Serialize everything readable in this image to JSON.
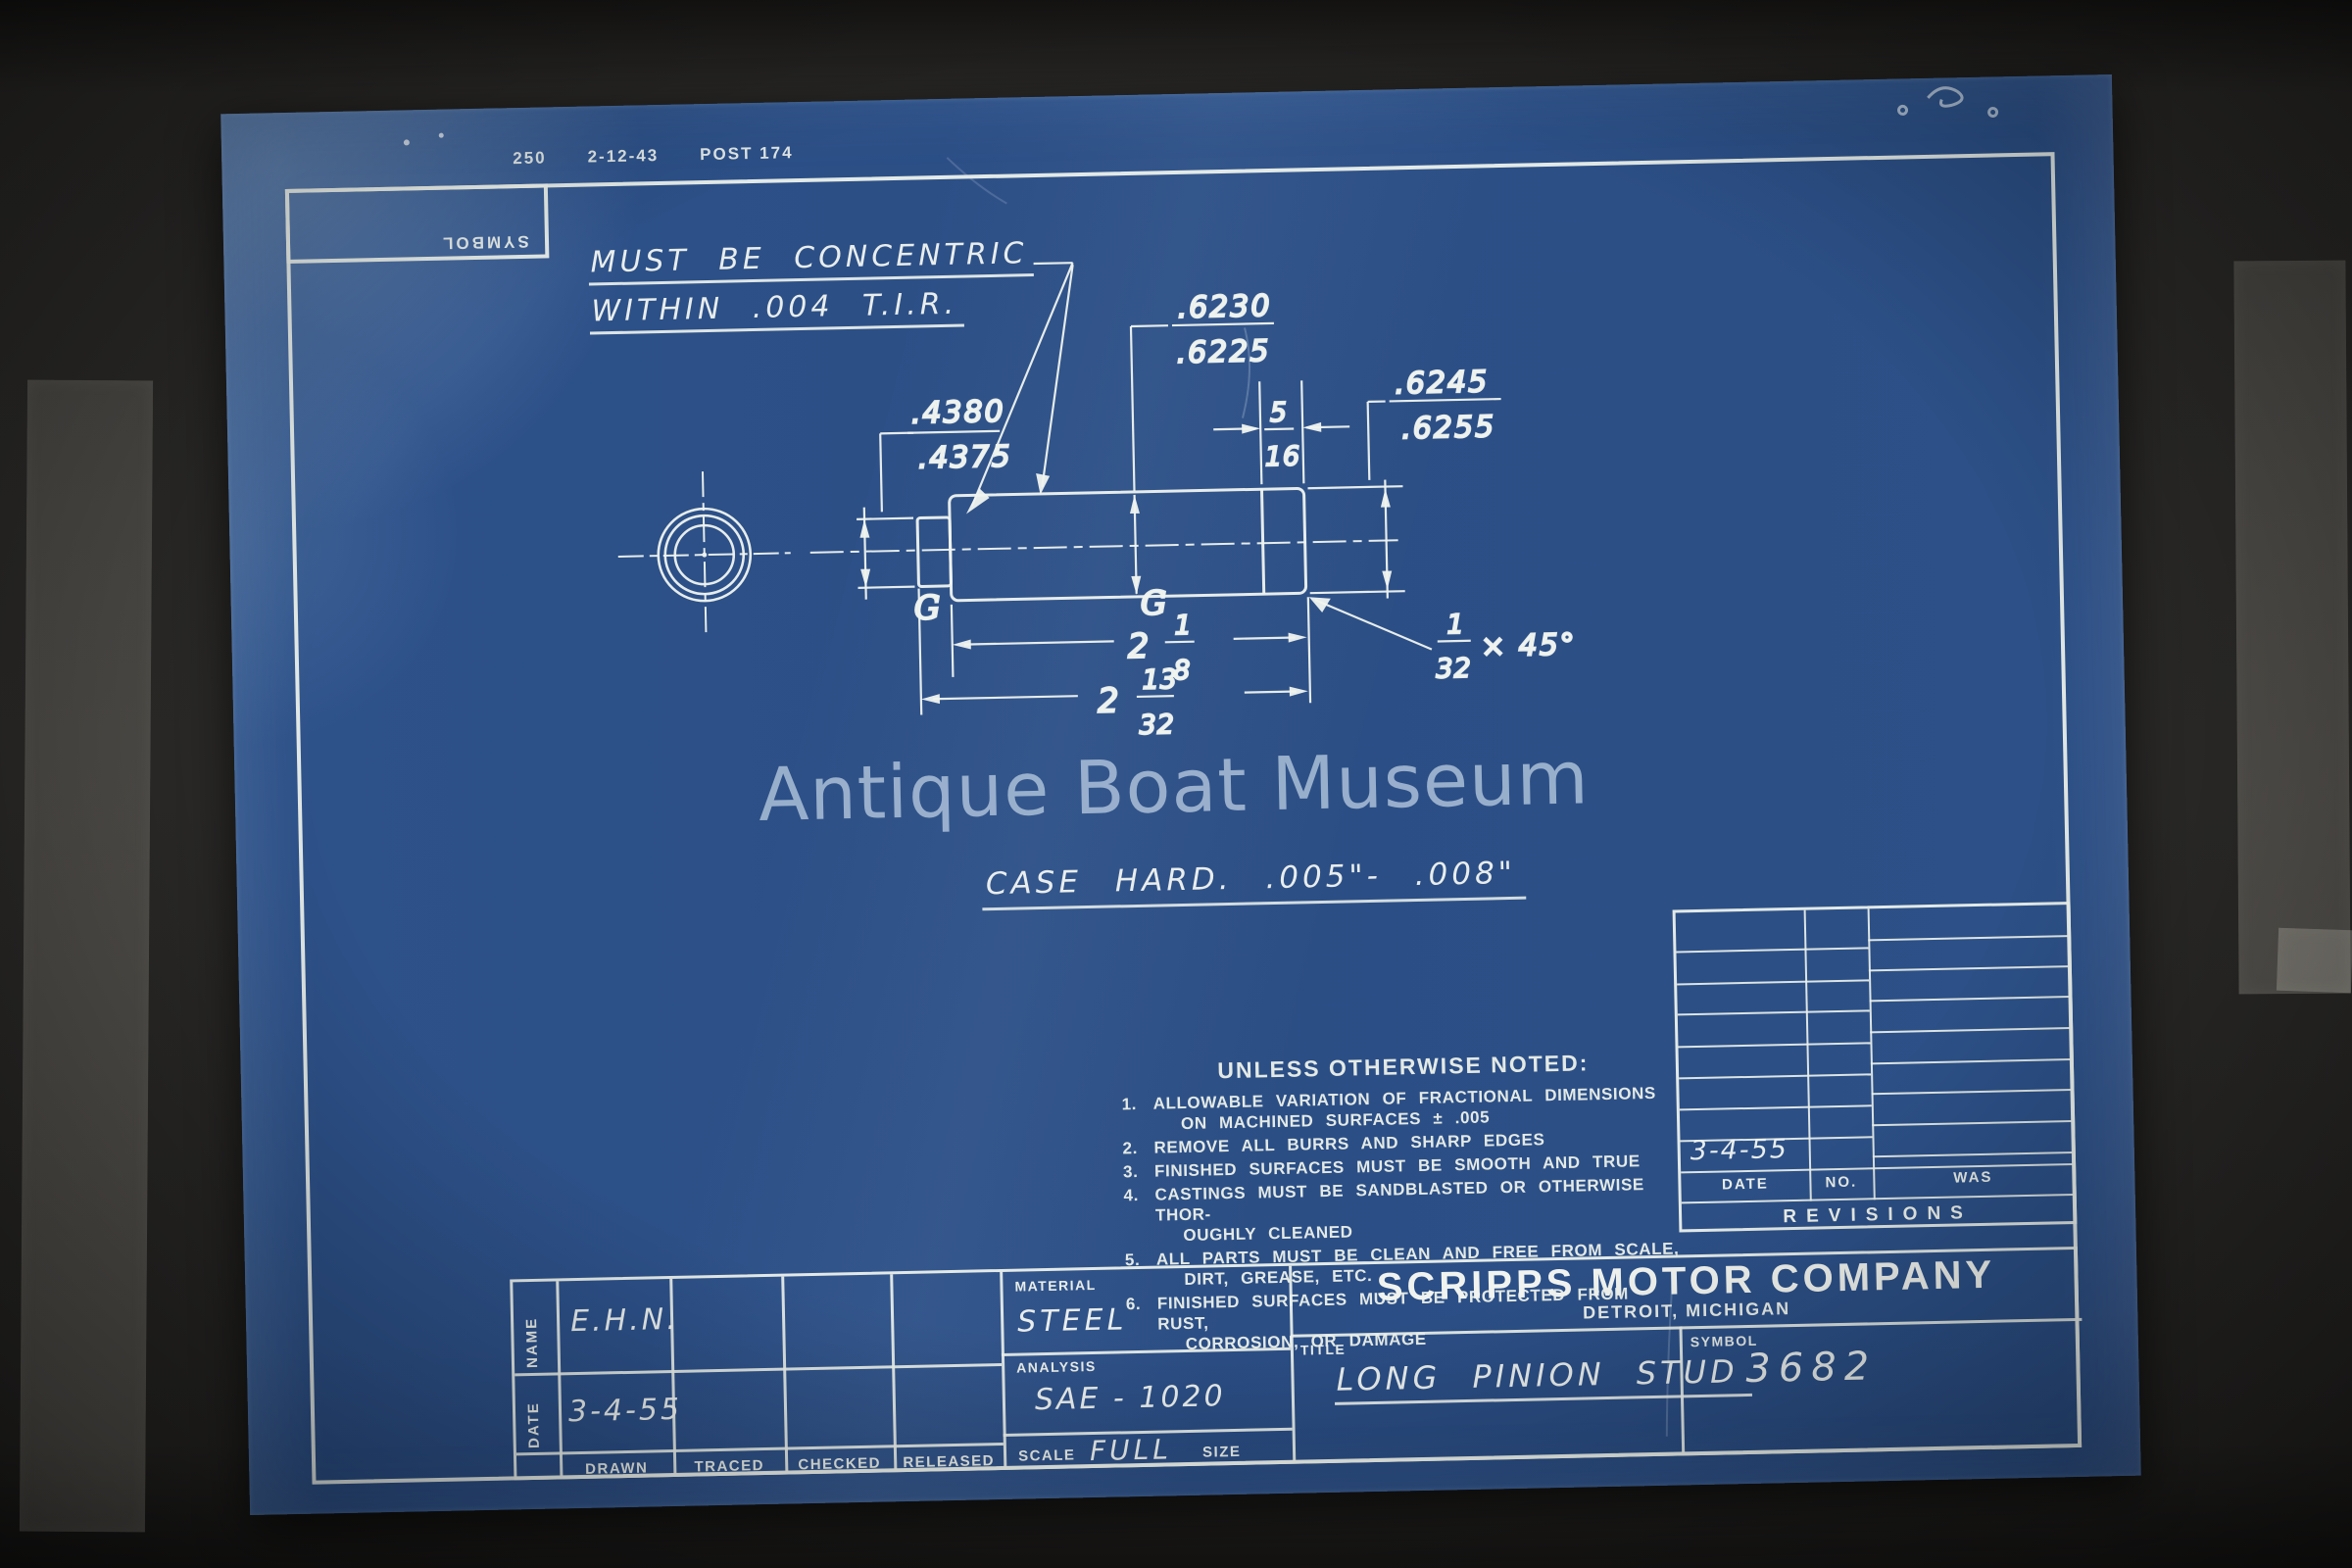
{
  "colors": {
    "blueprint": "#2b4e85",
    "ink": "#edf1ec",
    "watermark": "#acc0d8",
    "photo_background": "#2c2b29",
    "tape": "#cec8bc"
  },
  "stamp": {
    "part1": "250",
    "part2": "2-12-43",
    "part3": "POST 174"
  },
  "symbol_box": {
    "label": "SYMBOL"
  },
  "drawing": {
    "note_concentric_1": "MUST BE CONCENTRIC",
    "note_concentric_2": "WITHIN .004 T.I.R.",
    "case_hard_note": "CASE HARD.   .005\"- .008\"",
    "grind_mark": "G",
    "dims": {
      "stub_dia_upper": ".4380",
      "stub_dia_lower": ".4375",
      "body_dia_upper": ".6230",
      "body_dia_lower": ".6225",
      "end_dia_upper": ".6245",
      "end_dia_lower": ".6255",
      "end_len_num": "5",
      "end_len_den": "16",
      "body_len_whole": "2",
      "body_len_num": "1",
      "body_len_den": "8",
      "total_len_whole": "2",
      "total_len_num": "13",
      "total_len_den": "32",
      "chamfer_num": "1",
      "chamfer_den": "32",
      "chamfer_angle": "× 45°"
    }
  },
  "watermark": "Antique Boat Museum",
  "notes": {
    "heading": "UNLESS OTHERWISE NOTED:",
    "items": [
      {
        "no": "1.",
        "line1": "ALLOWABLE VARIATION OF FRACTIONAL DIMENSIONS",
        "line2": "ON MACHINED SURFACES ± .005"
      },
      {
        "no": "2.",
        "line1": "REMOVE ALL BURRS AND SHARP EDGES",
        "line2": ""
      },
      {
        "no": "3.",
        "line1": "FINISHED SURFACES MUST BE SMOOTH AND TRUE",
        "line2": ""
      },
      {
        "no": "4.",
        "line1": "CASTINGS MUST BE SANDBLASTED OR OTHERWISE THOR-",
        "line2": "OUGHLY CLEANED"
      },
      {
        "no": "5.",
        "line1": "ALL PARTS MUST BE CLEAN AND FREE FROM SCALE,",
        "line2": "DIRT, GREASE, ETC."
      },
      {
        "no": "6.",
        "line1": "FINISHED SURFACES MUST BE PROTECTED FROM RUST,",
        "line2": "CORROSION, OR DAMAGE"
      }
    ]
  },
  "revisions": {
    "date_header": "DATE",
    "no_header": "NO.",
    "was_header": "WAS",
    "banner": "REVISIONS",
    "last_date": "3-4-55"
  },
  "title_block": {
    "name_label": "NAME",
    "date_label": "DATE",
    "name_value": "E.H.N.",
    "date_value": "3-4-55",
    "drawn_label": "DRAWN",
    "traced_label": "TRACED",
    "checked_label": "CHECKED",
    "released_label": "RELEASED",
    "material_label": "MATERIAL",
    "material_value": "STEEL",
    "analysis_label": "ANALYSIS",
    "analysis_value": "SAE - 1020",
    "scale_label": "SCALE",
    "scale_value": "FULL",
    "size_label": "SIZE",
    "company_name": "SCRIPPS MOTOR COMPANY",
    "company_location": "DETROIT, MICHIGAN",
    "title_label": "TITLE",
    "title_value": "LONG PINION STUD",
    "symbol_label": "SYMBOL",
    "symbol_value": "3682"
  }
}
